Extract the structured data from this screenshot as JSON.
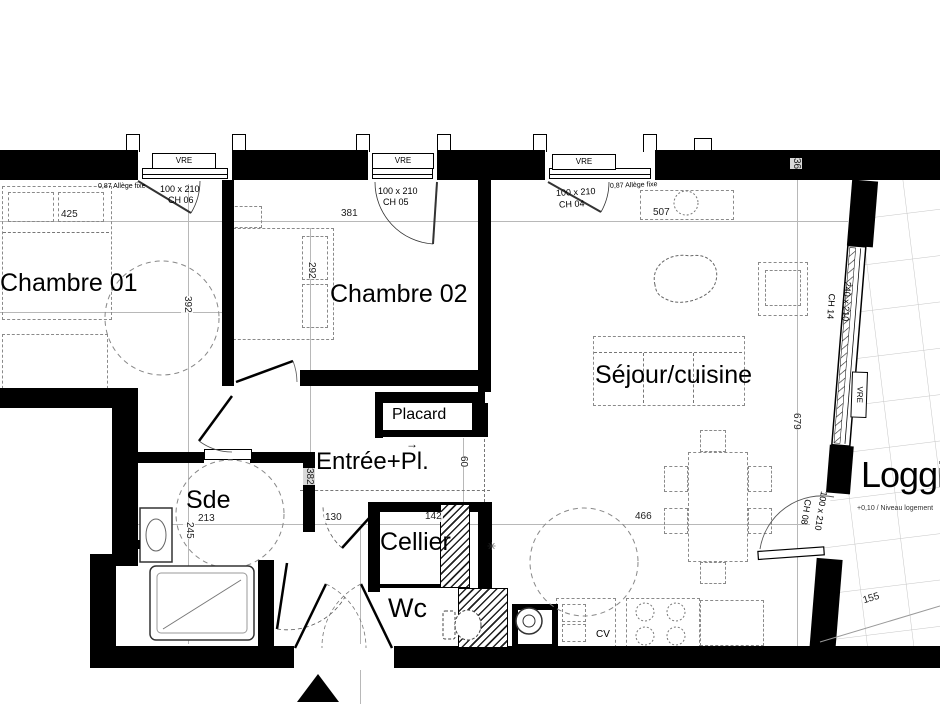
{
  "rooms": {
    "chambre01": "Chambre 01",
    "chambre02": "Chambre 02",
    "sejour": "Séjour/cuisine",
    "entree": "Entrée+Pl.",
    "placard": "Placard",
    "sde": "Sde",
    "cellier": "Cellier",
    "wc": "Wc",
    "loggia": "Loggia",
    "loggia_note": "+0,10 / Niveau logement"
  },
  "windows": {
    "vre": "VRE",
    "w1": {
      "size": "100 x 210",
      "ref": "CH 06",
      "sill": "0,87 Allège fixe"
    },
    "w2": {
      "size": "100 x 210",
      "ref": "CH 05"
    },
    "w3": {
      "size": "100 x 210",
      "ref": "CH 04",
      "sill": "0,87 Allège fixe"
    },
    "bay": {
      "size": "240 x 210",
      "ref": "CH 14"
    },
    "loggia_door": {
      "size": "100 x 210",
      "ref": "CH 08"
    }
  },
  "dimensions": {
    "ch01_width": "425",
    "ch02_width": "381",
    "sejour_width": "507",
    "ch01_depth": "392",
    "ch02_depth": "292",
    "entree_depth": "382",
    "sde_width": "213",
    "sde_depth": "245",
    "hall": "130",
    "cellier_width": "142",
    "passage": "60",
    "kitchen_width": "466",
    "sejour_depth": "679",
    "wall_offset": "36",
    "loggia_width": "155"
  },
  "labels": {
    "kitchen_hob": "CV",
    "arrow": "→",
    "floor_drain": "✳"
  }
}
